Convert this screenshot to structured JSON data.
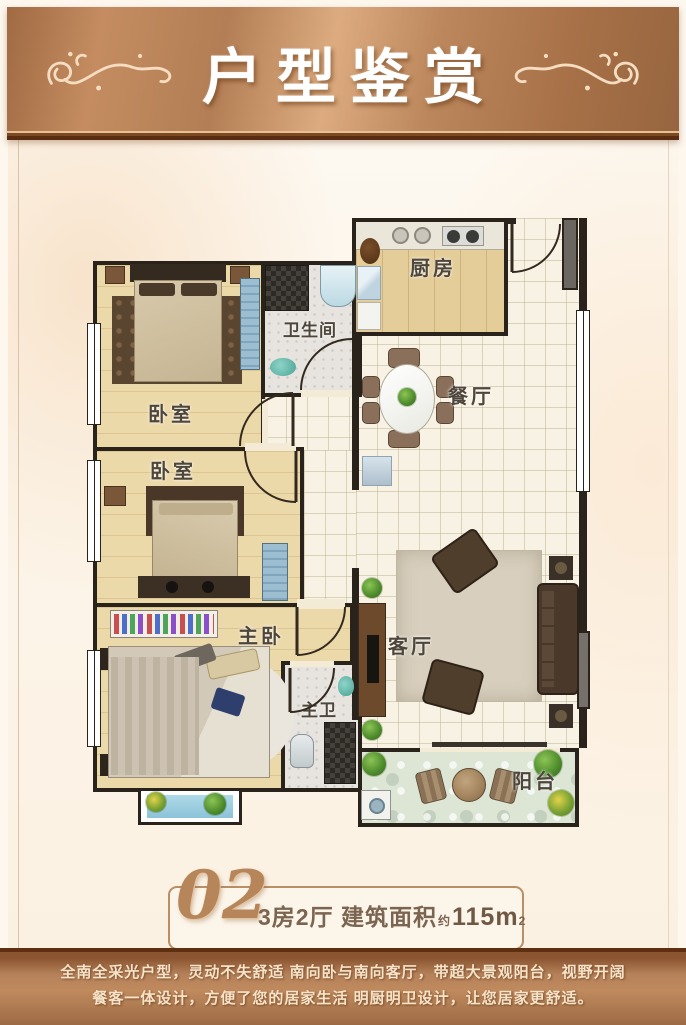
{
  "header": {
    "title": "户型鉴赏"
  },
  "plan": {
    "rooms": [
      {
        "id": "bedroom-top",
        "label": "卧室"
      },
      {
        "id": "bathroom",
        "label": "卫生间"
      },
      {
        "id": "kitchen",
        "label": "厨房"
      },
      {
        "id": "dining",
        "label": "餐厅"
      },
      {
        "id": "bedroom-middle",
        "label": "卧室"
      },
      {
        "id": "master-bedroom",
        "label": "主卧"
      },
      {
        "id": "master-bath",
        "label": "主卫"
      },
      {
        "id": "living",
        "label": "客厅"
      },
      {
        "id": "balcony",
        "label": "阳台"
      }
    ]
  },
  "info": {
    "unit_no": "02",
    "desc": "3房2厅  建筑面积",
    "approx": "约",
    "area": "115m",
    "area_sup": "2"
  },
  "footer": {
    "line1": "全南全采光户型，灵动不失舒适 南向卧与南向客厅，带超大景观阳台，视野开阔",
    "line2": "餐客一体设计，方便了您的居家生活 明厨明卫设计，让您居家更舒适。"
  },
  "colors": {
    "copper": "#bc8659",
    "copper_dark": "#5a2d12",
    "wall": "#29231b",
    "label_text": "#4e463a",
    "info_text": "#7b6450",
    "footer_text": "#f7e3c8"
  }
}
